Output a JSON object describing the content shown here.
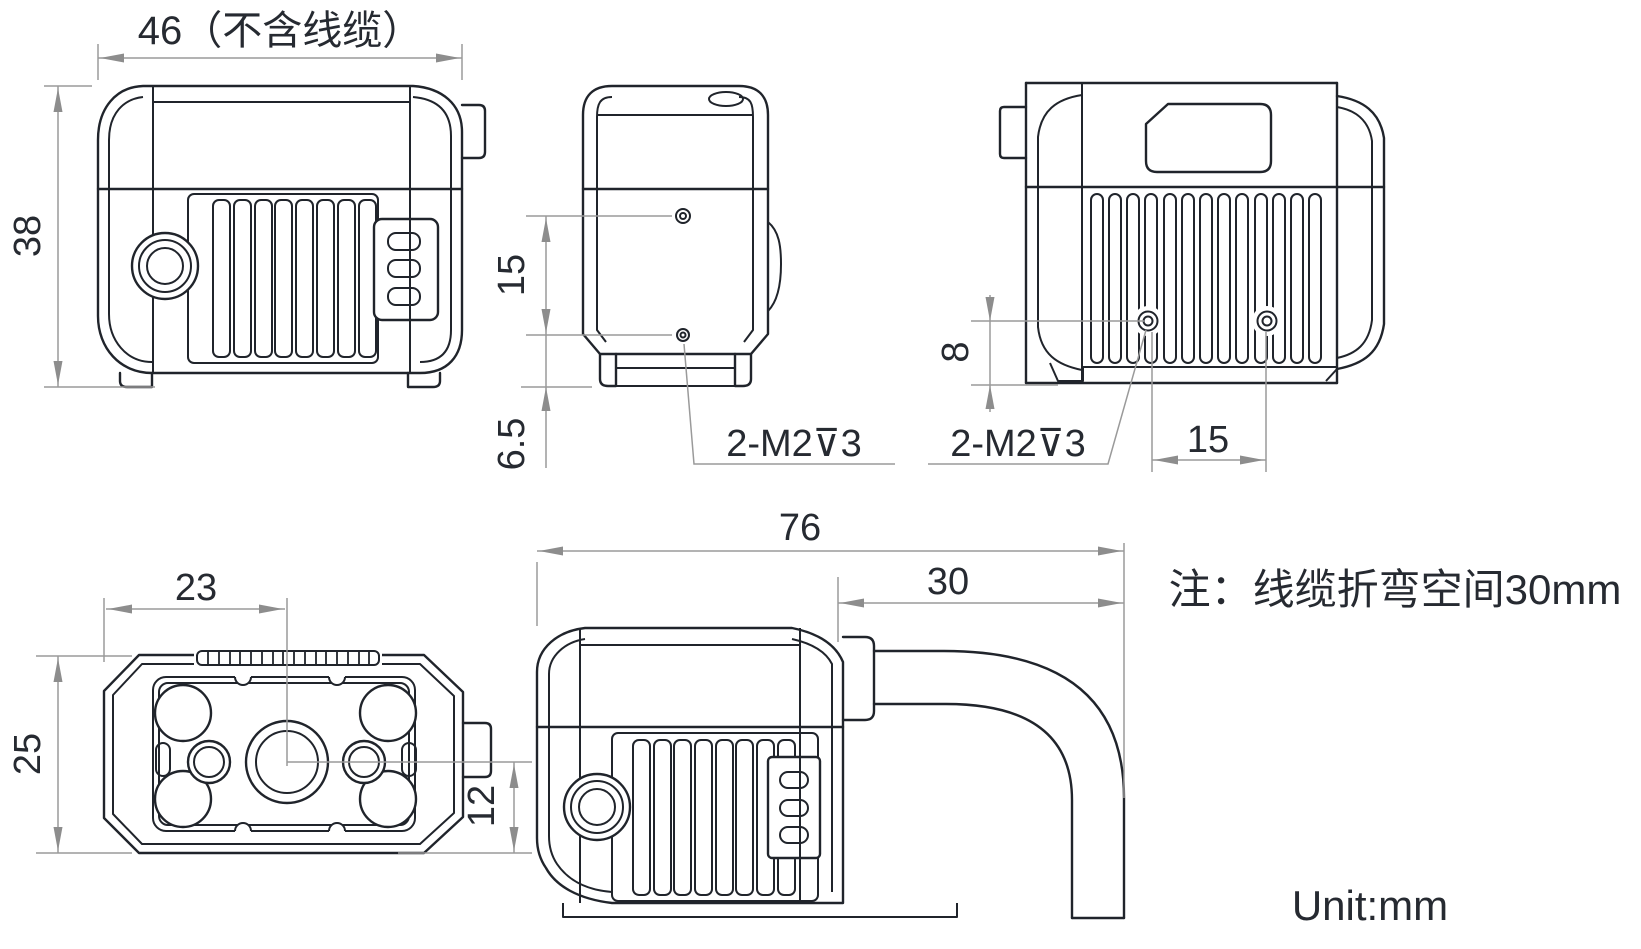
{
  "drawing": {
    "note": "注：线缆折弯空间30mm",
    "unit": "Unit:mm",
    "dims": {
      "width_excl_cable": "46（不含线缆）",
      "height": "38",
      "side_hole_spacing": "15",
      "side_hole_edge_offset": "6.5",
      "side_thread_callout": "2-M2⊽3",
      "rear_hole_bottom_offset": "8",
      "rear_thread_callout": "2-M2⊽3",
      "rear_hole_spacing": "15",
      "front_lens_center_x": "23",
      "front_height": "25",
      "front_lens_center_y": "12",
      "overall_depth_with_cable": "76",
      "cable_bend_space": "30"
    },
    "colors": {
      "line": "#20242b",
      "dimension": "#9a9a9a",
      "arrow": "#8d8d8d",
      "text": "#262a31",
      "background": "#ffffff"
    }
  }
}
